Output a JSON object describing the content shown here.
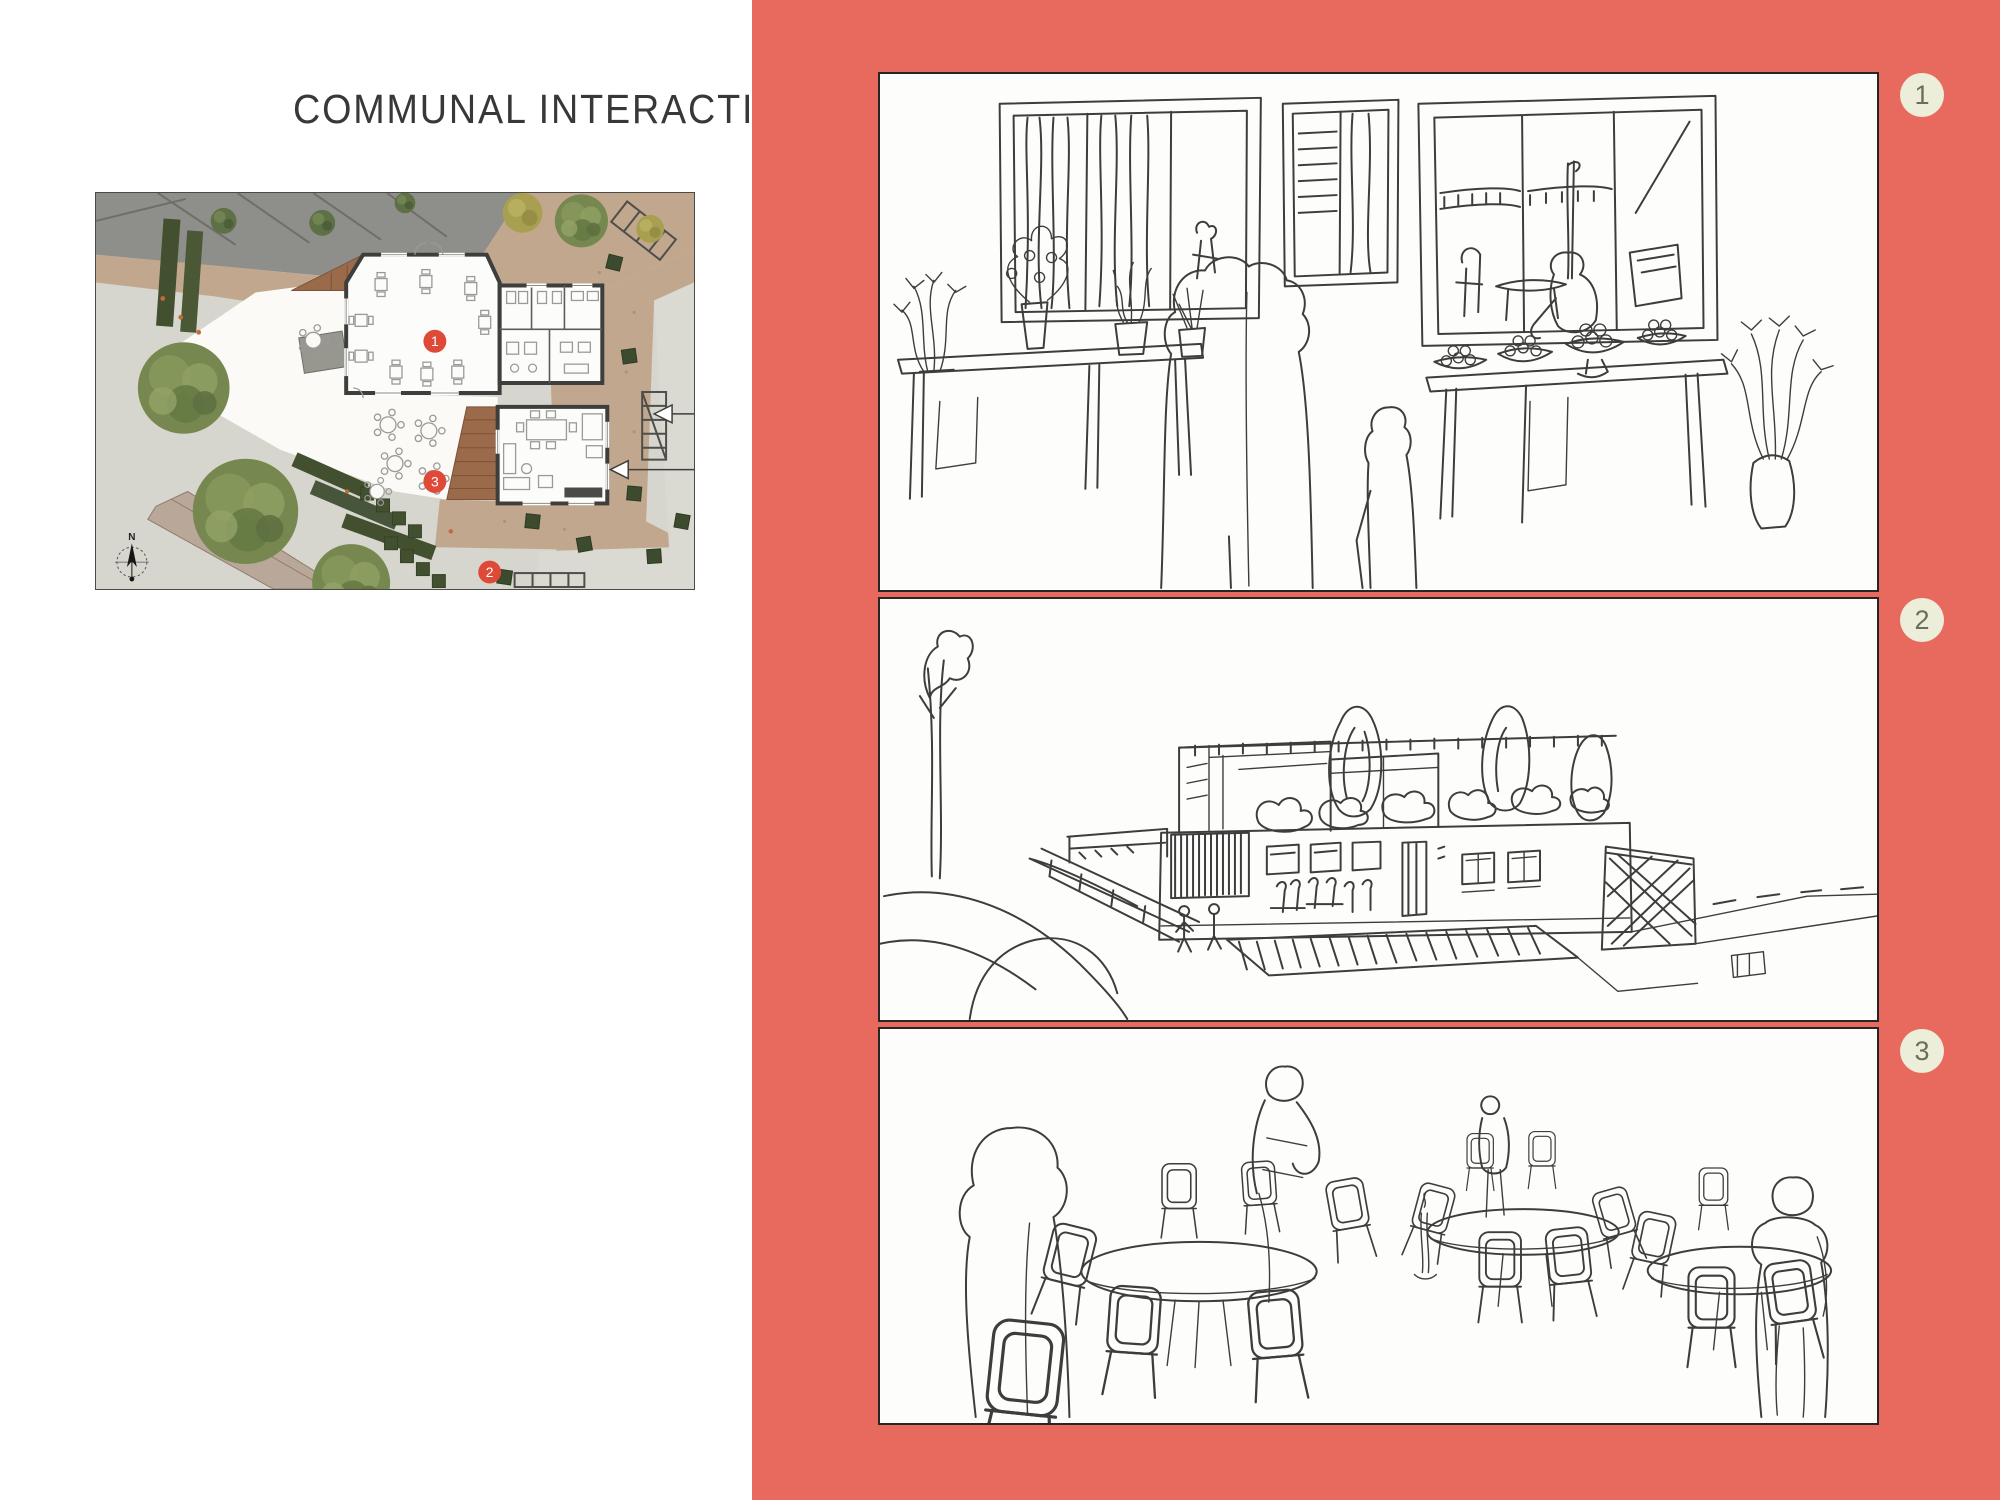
{
  "page": {
    "title": "COMMUNAL INTERACTION"
  },
  "colors": {
    "coral": "#e8695d",
    "badge-bg": "#edeeda",
    "badge-ink": "#6b6e5c",
    "marker-red": "#df4937",
    "ink": "#3d3d3d",
    "panel-bg": "#fdfdfb",
    "panel-border": "#262626",
    "title-ink": "#383838"
  },
  "plan": {
    "compass_label": "N",
    "markers": [
      {
        "label": "1"
      },
      {
        "label": "2"
      },
      {
        "label": "3"
      }
    ]
  },
  "badges": [
    {
      "label": "1"
    },
    {
      "label": "2"
    },
    {
      "label": "3"
    }
  ]
}
